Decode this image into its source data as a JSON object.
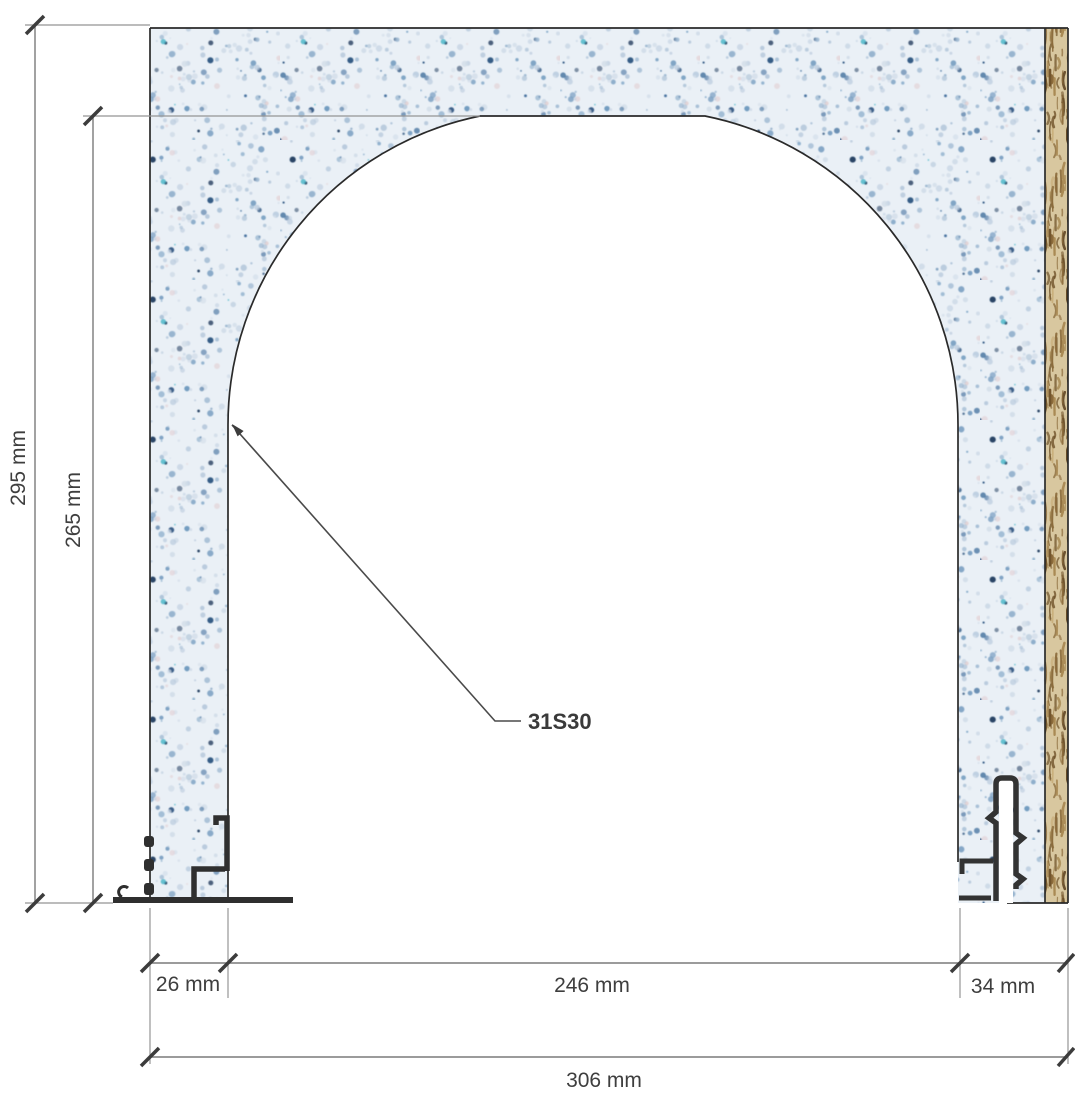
{
  "drawing": {
    "annotation_label": "31S30",
    "dimensions": {
      "total_height": "295 mm",
      "opening_height": "265 mm",
      "left_jamb_width": "26 mm",
      "opening_width": "246 mm",
      "right_jamb_width": "34 mm",
      "total_width": "306 mm"
    },
    "colors": {
      "panel_base": "#eaf0f6",
      "speckle_accent": "#44719e",
      "edge_strip_base": "#d8c79f",
      "edge_strip_grain": "#8a6a3a",
      "outline": "#2a2a2a",
      "profile": "#2f2f2f",
      "dimension_line": "#7a7a7a",
      "extension_line": "#959595",
      "tick": "#3c3c3c",
      "text": "#3e3e3e"
    }
  }
}
